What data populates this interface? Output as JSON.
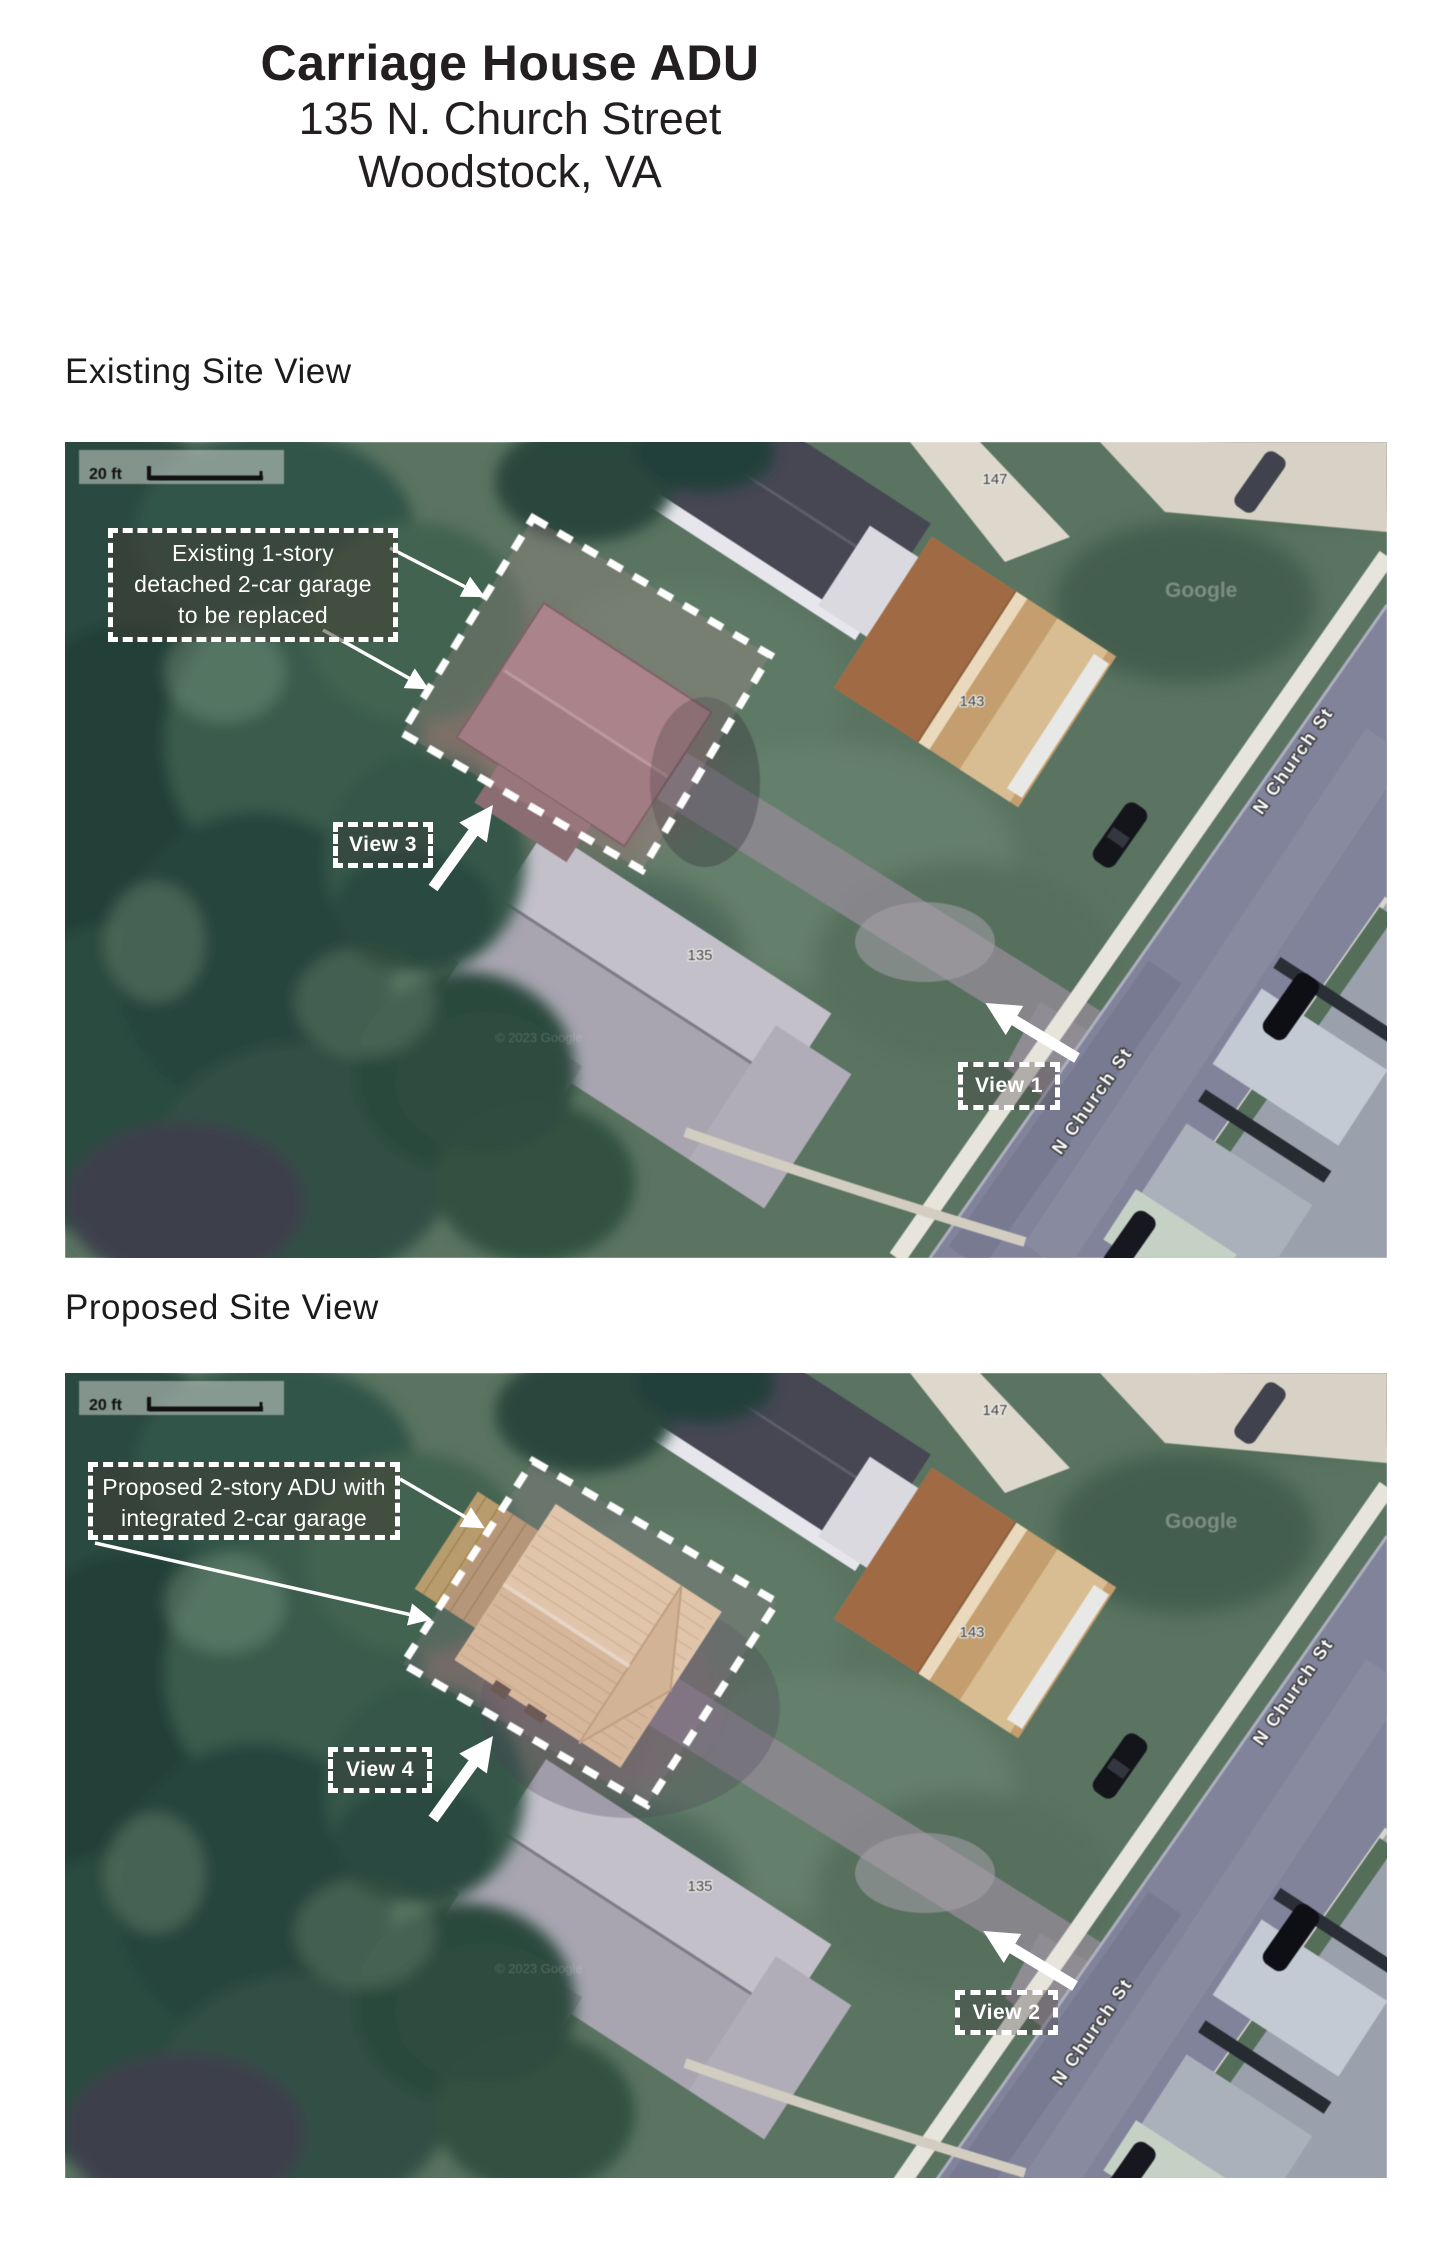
{
  "page": {
    "title": "Carriage House ADU",
    "address_line1": "135 N. Church Street",
    "address_line2": "Woodstock, VA"
  },
  "sections": {
    "existing_heading": "Existing Site View",
    "proposed_heading": "Proposed Site View"
  },
  "map_common": {
    "scale_label": "20 ft",
    "street_name": "N Church St",
    "house_number_147": "147",
    "house_number_143": "143",
    "house_number_135": "135",
    "watermark": "Google",
    "copyright": "© 2023 Google"
  },
  "existing_map": {
    "annotation_line1": "Existing 1-story",
    "annotation_line2": "detached 2-car garage",
    "annotation_line3": "to be replaced",
    "view_label_3": "View 3",
    "view_label_1": "View 1"
  },
  "proposed_map": {
    "annotation_line1": "Proposed 2-story ADU with",
    "annotation_line2": "integrated 2-car garage",
    "view_label_4": "View 4",
    "view_label_2": "View 2"
  },
  "colors": {
    "annotation_dash": "#ffffff",
    "existing_garage_roof": "#9e7f83",
    "proposed_adu_roof": "#ecd6ae",
    "street": "#80839a",
    "lawn": "#5a7461"
  }
}
